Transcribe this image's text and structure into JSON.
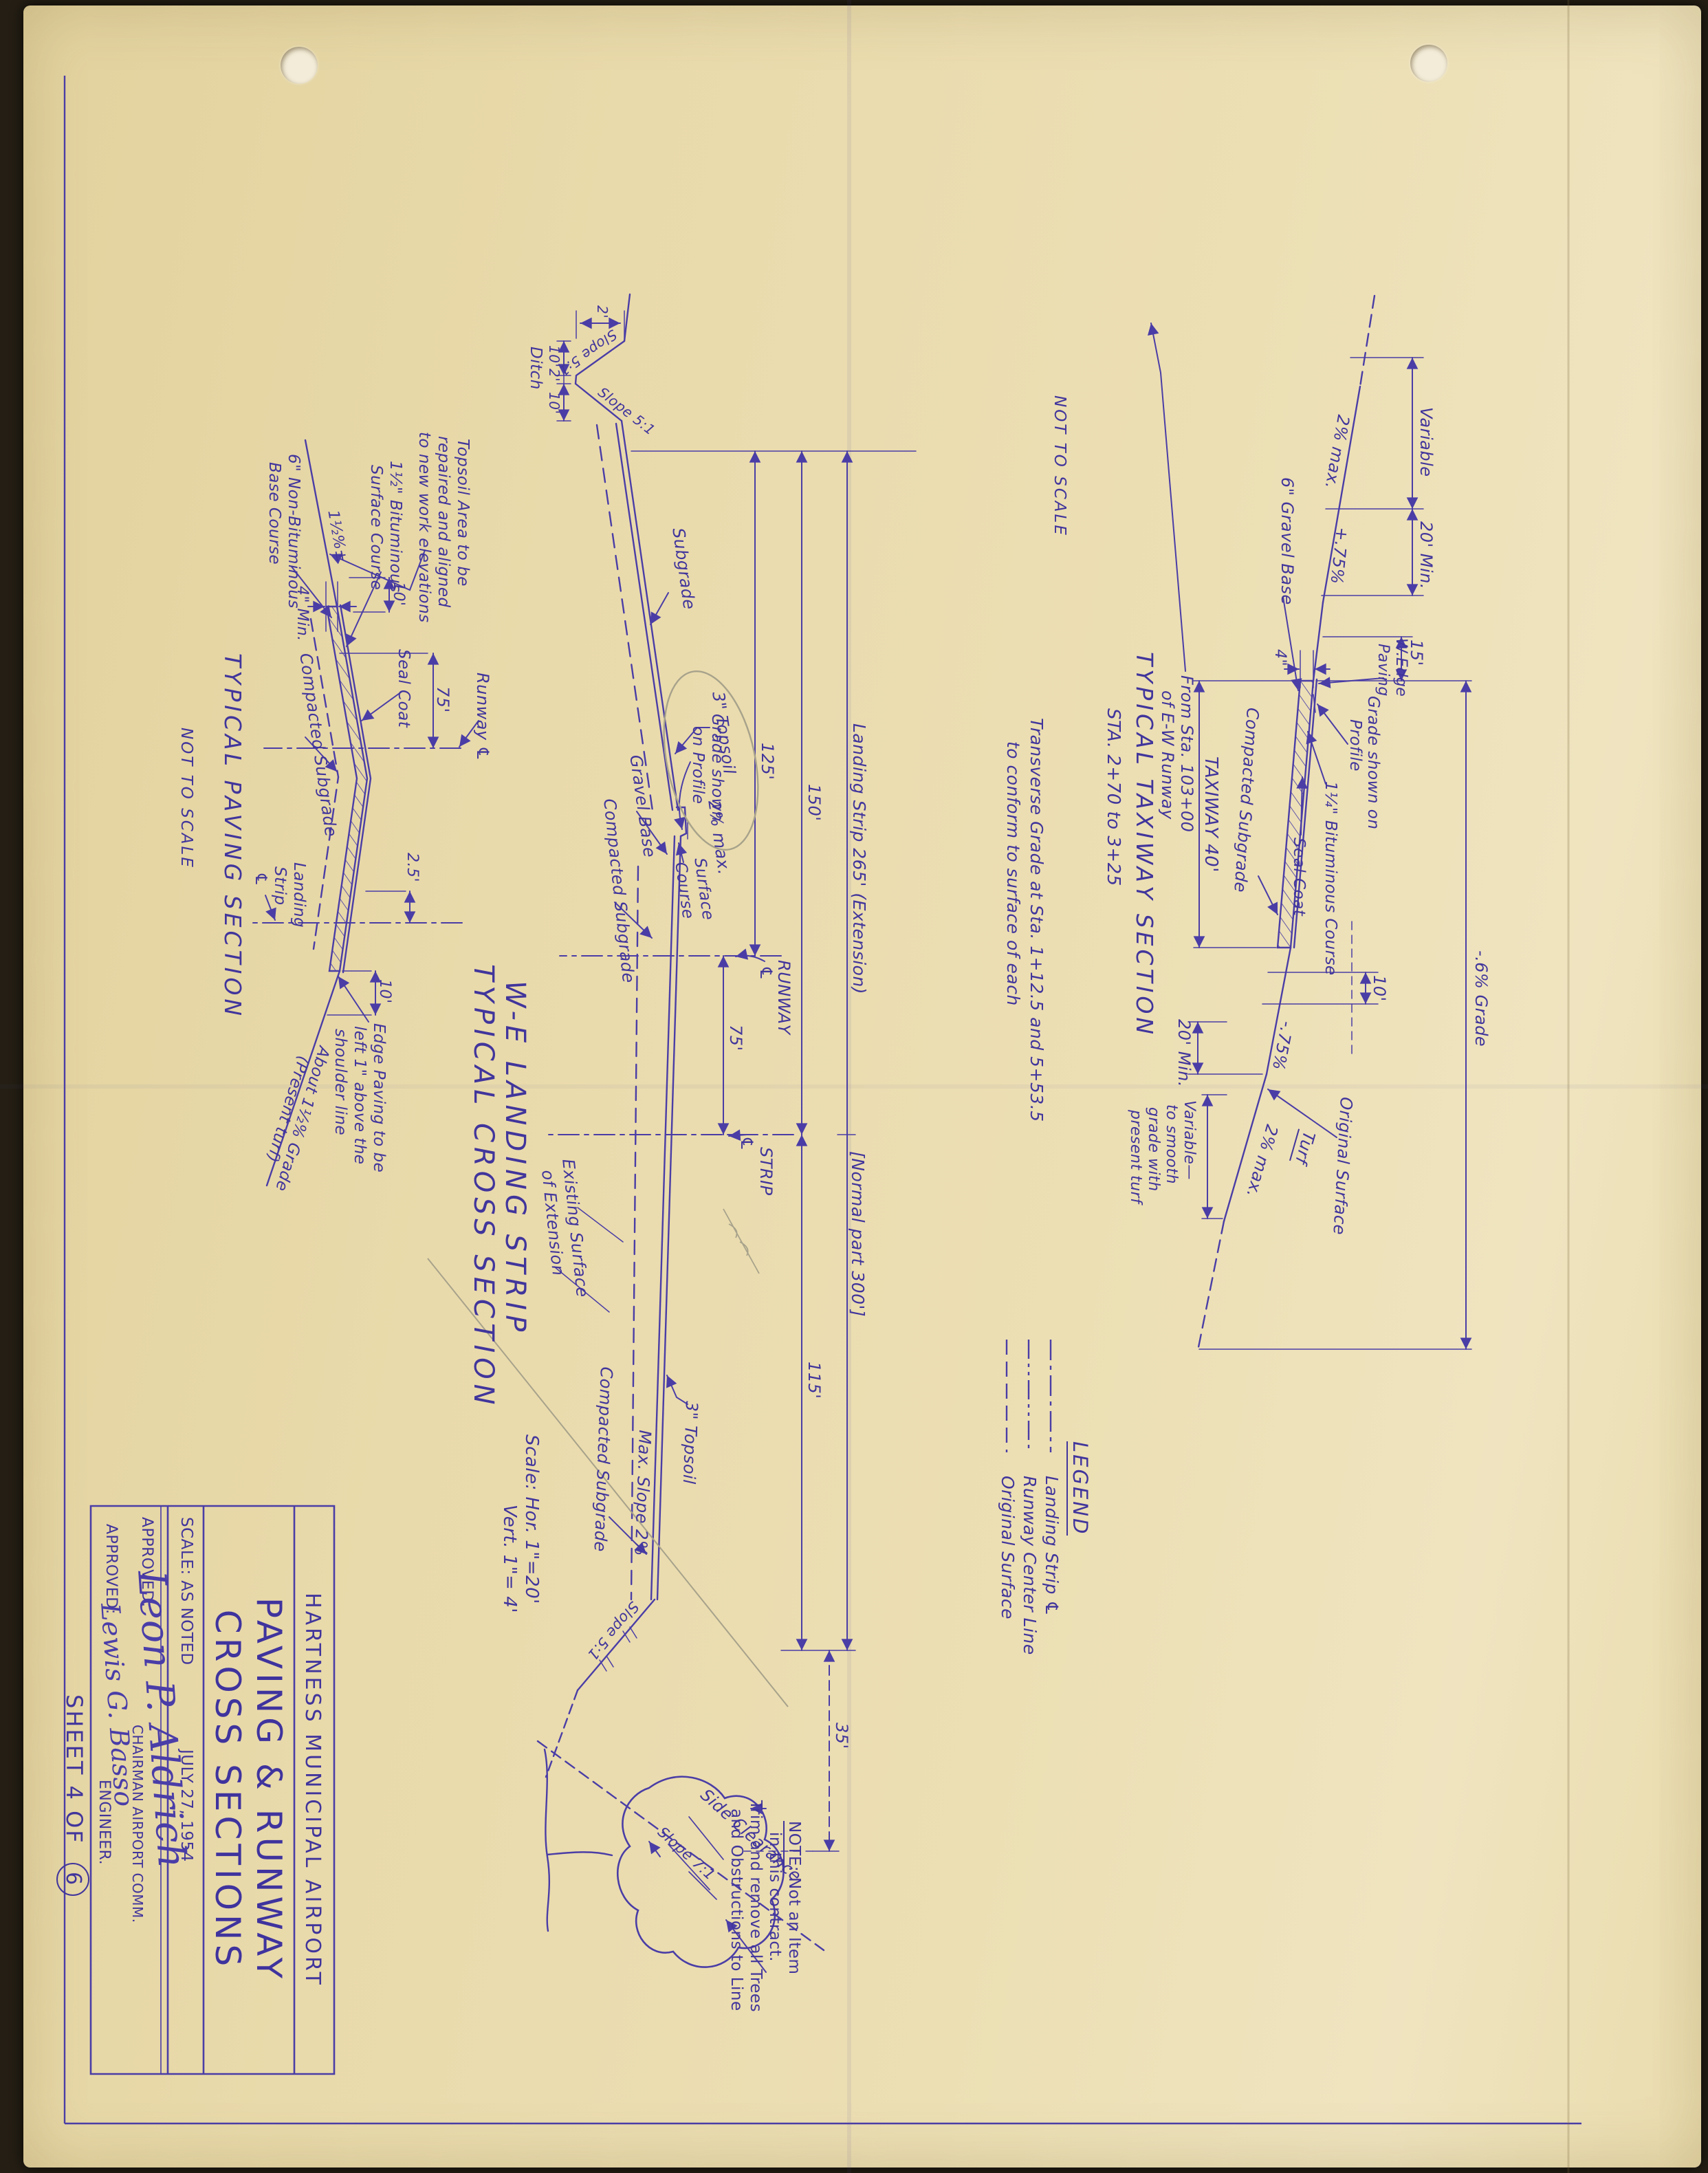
{
  "page": {
    "sheet_label": "SHEET 4 OF",
    "sheet_number": "6"
  },
  "title_block": {
    "organization": "HARTNESS  MUNICIPAL  AIRPORT",
    "title_line1": "PAVING & RUNWAY",
    "title_line2": "CROSS SECTIONS",
    "scale": "SCALE: AS NOTED",
    "date": "JULY 27, 1954",
    "approved_label": "APPROVED:",
    "signature_chairman": "Leon P. Aldrich",
    "role_chairman": "CHAIRMAN AIRPORT COMM.",
    "signature_engineer": "Lewis G. Basso",
    "role_engineer": "ENGINEER."
  },
  "legend": {
    "title": "LEGEND",
    "items": [
      {
        "style": "dash-dot",
        "label": "Landing Strip ℄"
      },
      {
        "style": "dash-dot-dot",
        "label": "Runway Center Line"
      },
      {
        "style": "dashed",
        "label": "Original Surface"
      }
    ]
  },
  "taxiway": {
    "title": "TYPICAL TAXIWAY SECTION",
    "station_range": "STA. 2+70 to 3+25",
    "not_to_scale": "NOT TO SCALE",
    "transverse_note_line1": "Transverse Grade at Sta. 1+12.5 and 5+53.5",
    "transverse_note_line2": "to conform to surface of each",
    "from_sta_line1": "From Sta. 103+00",
    "from_sta_line2": "of E-W Runway",
    "slope_2pct_max": "2% max.",
    "dim_variable": "Variable",
    "dim_20min": "20' Min.",
    "slope_plus75": "+.75%",
    "gravel_base": "6\" Gravel Base",
    "dim_15": "15'",
    "w_edge_line1": "W.Edge",
    "w_edge_line2": "Paving",
    "dim_4in": "4\"",
    "grade_profile_line1": "Grade shown on",
    "grade_profile_line2": "Profile",
    "grade_minus6": "-.6% Grade",
    "compacted_subgrade": "Compacted Subgrade",
    "taxiway_dim": "TAXIWAY   40'",
    "bituminous_course": "1¼\" Bituminous Course",
    "seal_coat": "Seal Coat",
    "dim_10": "10'",
    "slope_minus75": "-.75%",
    "original_surface": "Original Surface",
    "turf": "Turf",
    "variable_note_line1": "Variable—",
    "variable_note_line2": "to smooth",
    "variable_note_line3": "grade with",
    "variable_note_line4": "present turf"
  },
  "cross_section": {
    "title_line1": "W-E  LANDING  STRIP",
    "title_line2": "TYPICAL  CROSS  SECTION",
    "scale_line1": "Scale:  Hor. 1\"=20'",
    "scale_line2": "Vert. 1\"= 4'",
    "dim_125": "125'",
    "dim_150": "150'",
    "dim_landing_strip_265": "Landing Strip   265' (Extension)",
    "dim_normal_300": "[Normal part 300']",
    "dim_75": "75'",
    "dim_115": "115'",
    "dim_35": "35'",
    "runway_label": "RUNWAY",
    "strip_label": "STRIP",
    "cl_symbol": "℄",
    "ditch": "Ditch",
    "slope_5_1": "Slope 5:1",
    "dim_2ft": "2'",
    "dim_10ft": "10'",
    "subgrade": "Subgrade",
    "topsoil_3in": "3\" Topsoil",
    "slope_2pct": "2% max.",
    "grade_profile_line1": "Grade shown",
    "grade_profile_line2": "on Profile",
    "gravel_base": "Gravel Base",
    "compacted_subgrade": "Compacted Subgrade",
    "surface_course_line1": "Surface",
    "surface_course_line2": "Course",
    "existing_line1": "Existing Surface",
    "existing_line2": "of Extension",
    "max_slope_2pct": "Max. Slope 2%",
    "side_clearance": "Side Clearance",
    "slope_7_1": "Slope 7:1",
    "note_line1a": "NOTE:",
    "note_line1b": " Not an Item",
    "note_line2": "in this contract.",
    "note_line3": "Trim and remove all Trees",
    "note_line4": "and Obstructions to Line"
  },
  "paving": {
    "title": "TYPICAL PAVING SECTION",
    "not_to_scale": "NOT TO SCALE",
    "topsoil_note_line1": "Topsoil Area to be",
    "topsoil_note_line2": "repaired and aligned",
    "topsoil_note_line3": "to new work elevations",
    "bituminous_line1": "1½\" Bituminous",
    "bituminous_line2": "Surface Course",
    "base_line1": "6\" Non-Bituminous",
    "base_line2": "Base Course",
    "grade_1half": "1½%±",
    "min_4in": "4\" Min.",
    "dim_10": "10'",
    "compacted_subgrade": "Compacted Subgrade",
    "seal_coat": "Seal Coat",
    "dim_75": "75'",
    "runway_label": "Runway ℄",
    "landing_line1": "Landing",
    "landing_line2": "Strip",
    "cl_symbol": "℄",
    "dim_2_5": "2.5'",
    "edge_note_line1": "Edge Paving to be",
    "edge_note_line2": "left 1\" above the",
    "edge_note_line3": "shoulder line",
    "about_grade_line1": "About 1½% Grade",
    "about_grade_line2": "(Present turf)"
  }
}
